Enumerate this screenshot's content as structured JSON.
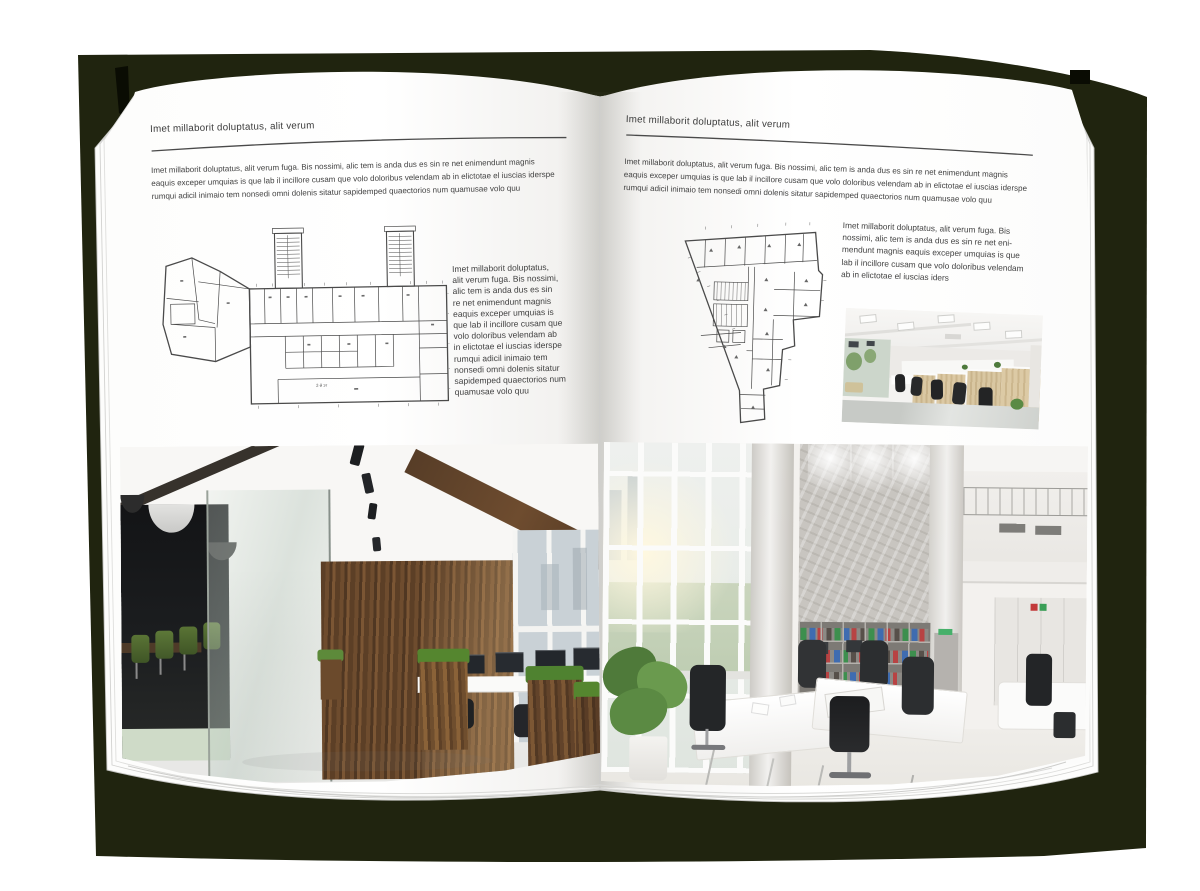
{
  "palette": {
    "cover": "#20240f",
    "page": "#ffffff",
    "rule": "#4a4a4a",
    "text": "#3d3d3d"
  },
  "left_page": {
    "header": "Imet millaborit doluptatus, alit verum",
    "intro_lines": [
      "Imet millaborit doluptatus, alit verum fuga. Bis nossimi, alic tem is anda dus es sin re net enimendunt magnis",
      "eaquis exceper umquias is que lab il incillore cusam que volo doloribus velendam ab in elictotae el iuscias iderspe",
      "rumqui adicil inimaio tem nonsedi omni dolenis sitatur sapidemped quaectorios num quamusae volo quu"
    ],
    "floorplan_caption": "2-й эт",
    "side_text_lines": [
      "Imet millaborit doluptatus,",
      "alit verum fuga. Bis nossimi,",
      "alic tem is anda dus es sin",
      "re net enimendunt magnis",
      "eaquis exceper umquias is",
      "que lab il incillore cusam que",
      "volo doloribus velendam ab",
      "in elictotae el iuscias iderspe",
      "rumqui adicil inimaio tem",
      "nonsedi omni dolenis sitatur",
      "sapidemped quaectorios num",
      "quamusae volo quu"
    ]
  },
  "right_page": {
    "header": "Imet millaborit doluptatus, alit verum",
    "intro_lines": [
      "Imet millaborit doluptatus, alit verum fuga. Bis nossimi, alic tem is anda dus es sin re net enimendunt magnis",
      "eaquis exceper umquias is que lab il incillore cusam que volo doloribus velendam ab in elictotae el iuscias iderspe",
      "rumqui adicil inimaio tem nonsedi omni dolenis sitatur sapidemped quaectorios num quamusae volo quu"
    ],
    "side_text_lines": [
      "Imet millaborit doluptatus, alit verum fuga. Bis",
      "nossimi, alic tem is anda dus es sin re net eni-",
      "mendunt magnis eaquis exceper umquias is que",
      "lab il incillore cusam que volo doloribus velendam",
      "ab in elictotae el iuscias iders"
    ]
  }
}
